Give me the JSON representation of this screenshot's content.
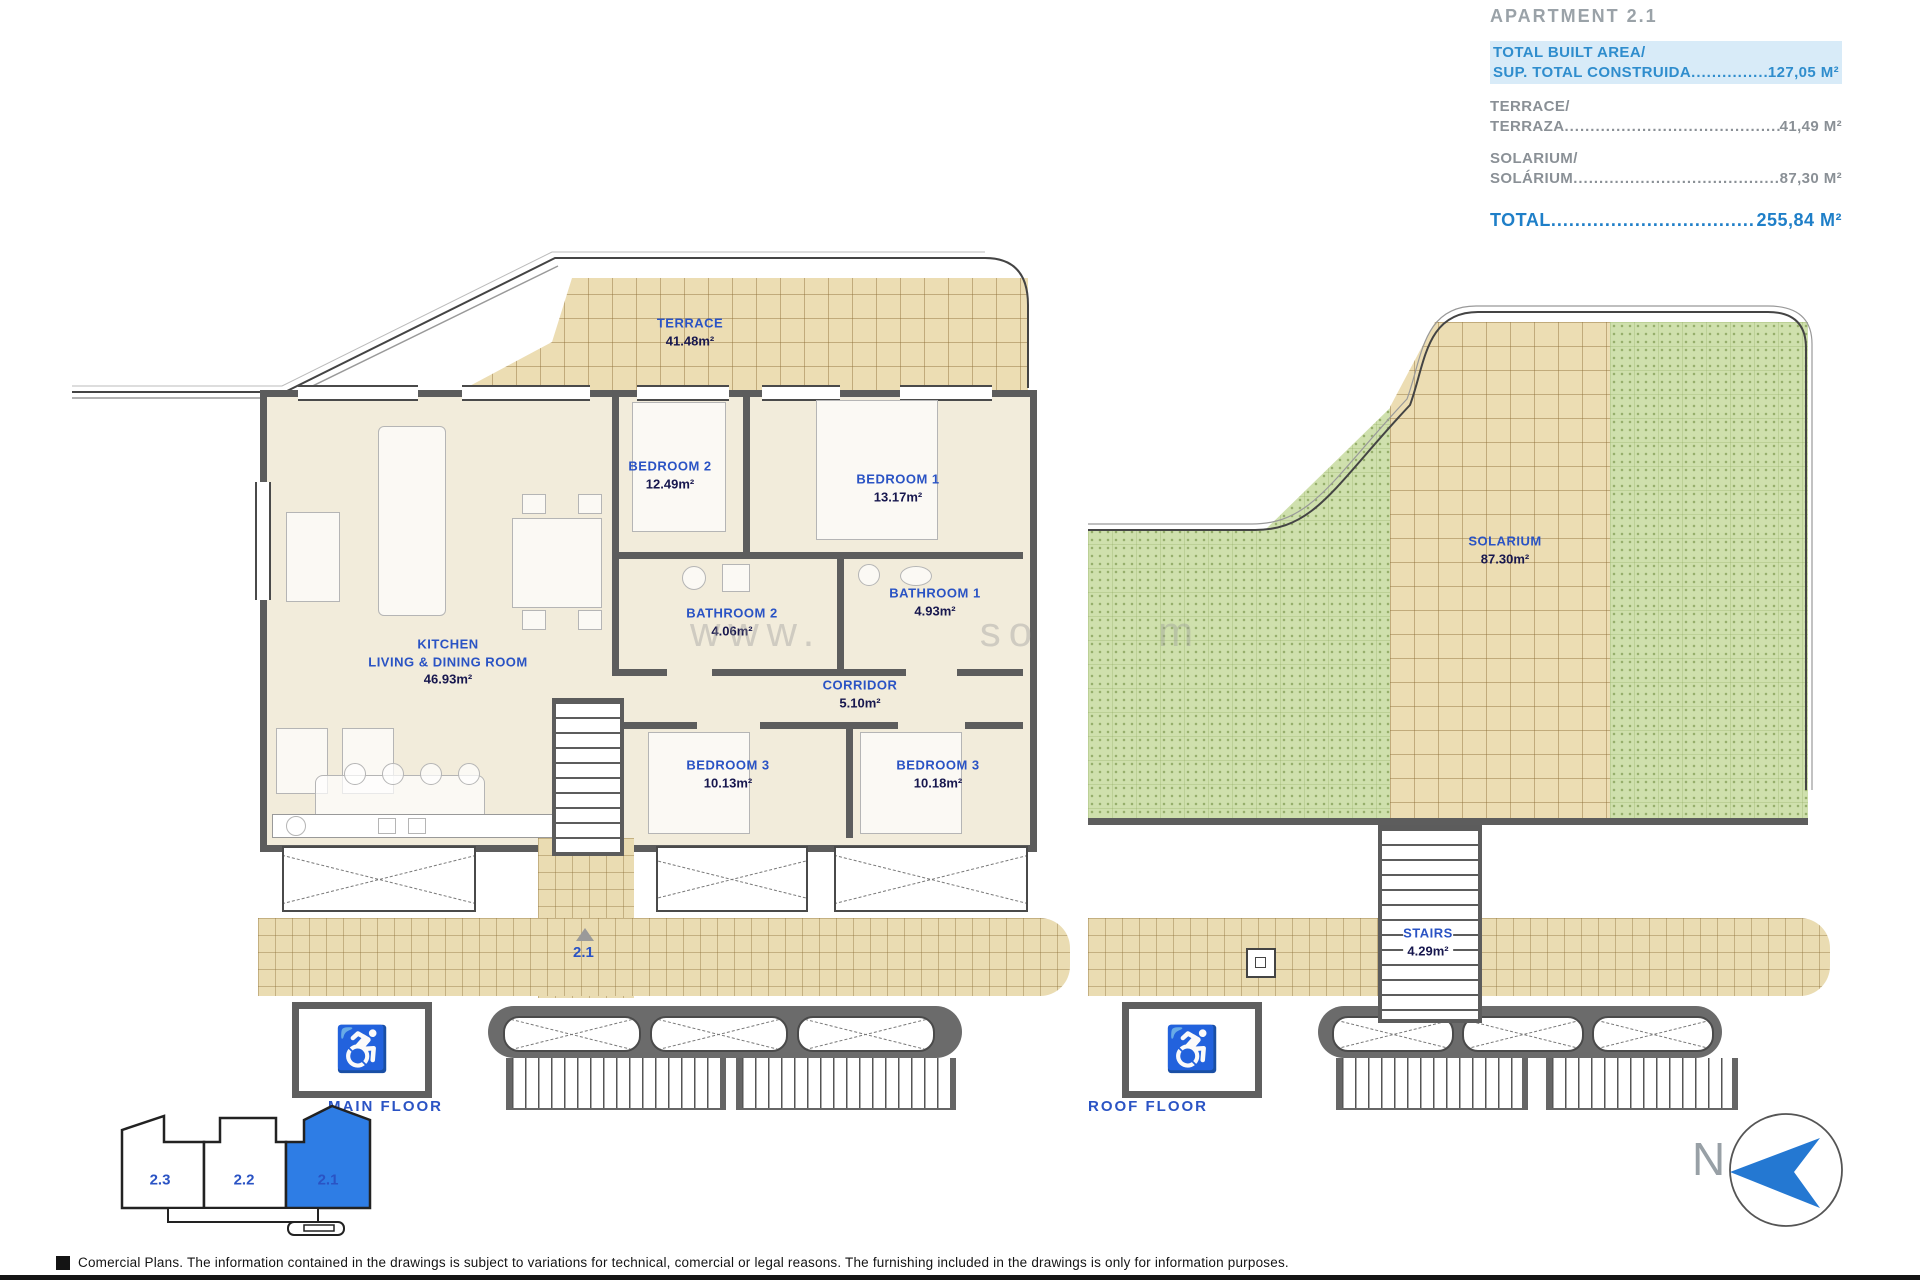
{
  "summary": {
    "title": "APARTMENT 2.1",
    "built_line1": "TOTAL BUILT AREA/",
    "built_line2": "SUP. TOTAL CONSTRUIDA",
    "built_dots": "................",
    "built_value": "127,05 M²",
    "terrace_line1": "TERRACE/",
    "terrace_line2": "TERRAZA",
    "terrace_dots": "......................................................",
    "terrace_value": "41,49 M²",
    "solarium_line1": "SOLARIUM/",
    "solarium_line2": "SOLÁRIUM",
    "solarium_dots": "....................................................",
    "solarium_value": "87,30 M²",
    "total_label": "TOTAL",
    "total_dots": ".......................................",
    "total_value": "255,84 M²"
  },
  "plans": {
    "main": {
      "floor_label": "MAIN FLOOR",
      "entrance_marker": "2.1",
      "terrace": {
        "name": "TERRACE",
        "area": "41.48m²"
      },
      "bedroom2": {
        "name": "BEDROOM 2",
        "area": "12.49m²"
      },
      "bedroom1": {
        "name": "BEDROOM 1",
        "area": "13.17m²"
      },
      "bathroom2": {
        "name": "BATHROOM 2",
        "area": "4.06m²"
      },
      "bathroom1": {
        "name": "BATHROOM 1",
        "area": "4.93m²"
      },
      "kitchen": {
        "line1": "KITCHEN",
        "line2": "LIVING & DINING ROOM",
        "area": "46.93m²"
      },
      "corridor": {
        "name": "CORRIDOR",
        "area": "5.10m²"
      },
      "bedroom3a": {
        "name": "BEDROOM 3",
        "area": "10.13m²"
      },
      "bedroom3b": {
        "name": "BEDROOM 3",
        "area": "10.18m²"
      }
    },
    "roof": {
      "floor_label": "ROOF FLOOR",
      "solarium": {
        "name": "SOLARIUM",
        "area": "87.30m²"
      },
      "stairs": {
        "name": "STAIRS",
        "area": "4.29m²"
      }
    }
  },
  "key_plan": {
    "units": [
      "2.3",
      "2.2",
      "2.1"
    ],
    "highlighted": "2.1"
  },
  "compass": {
    "north_label": "N"
  },
  "watermark": {
    "text": "www.        so      m"
  },
  "footer": {
    "text": "Comercial Plans. The information contained in the drawings is subject to variations for technical, comercial or legal reasons. The furnishing included in the drawings is only for information purposes."
  },
  "colors": {
    "accent_blue": "#2f8dcd",
    "room_label_blue": "#2a53c4",
    "highlight_bg": "#d8ebf8",
    "key_highlight": "#2e7de5",
    "tile_tan": "#ecddb3",
    "tile_green": "#cfe0ad",
    "wall_gray": "#5d5d5d"
  }
}
